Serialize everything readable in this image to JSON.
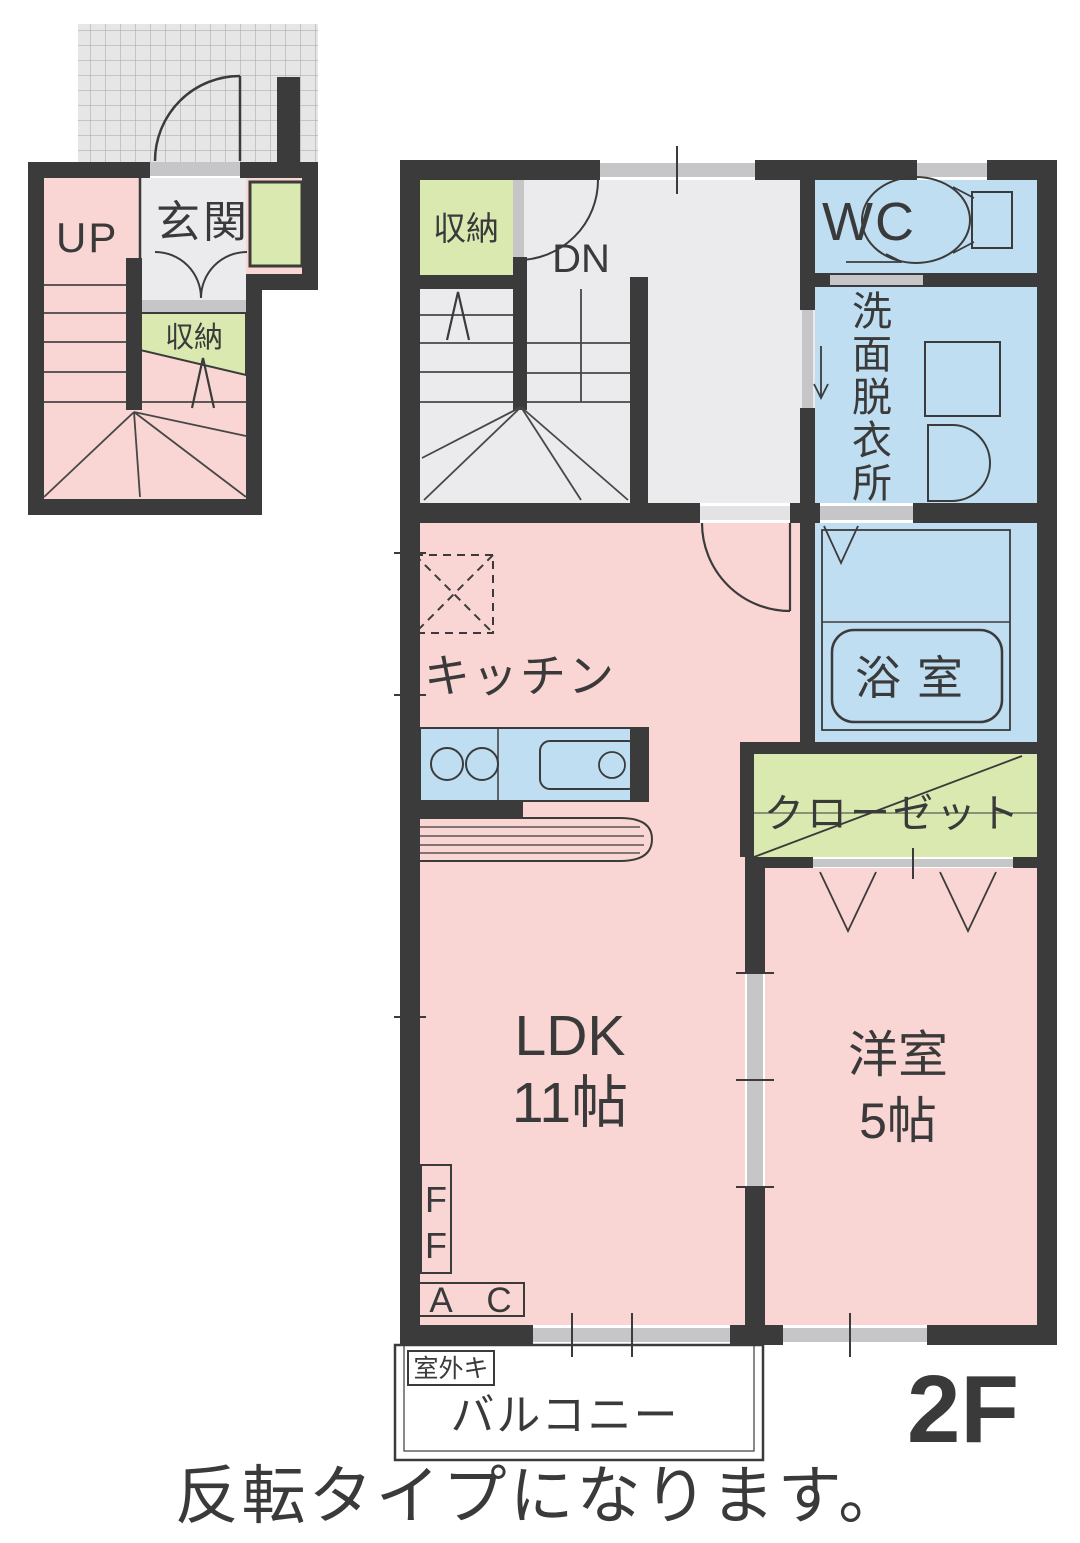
{
  "page": {
    "caption": "反転タイプになります。",
    "floor_label": "2F"
  },
  "colors": {
    "wall": "#3b3b3b",
    "room_pink": "#f9d6d3",
    "room_blue": "#bfdef1",
    "room_green": "#d9e9af",
    "hall_gray": "#ebebed",
    "opening_gray": "#c6c6c8",
    "porch_tile": "#e6e6e6"
  },
  "first_floor": {
    "up": "UP",
    "entrance": "玄関",
    "storage": "収納"
  },
  "second_floor": {
    "storage": "収納",
    "down": "DN",
    "wc": "WC",
    "washroom": "洗面脱衣所",
    "washroom_chars": [
      "洗",
      "面",
      "脱",
      "衣",
      "所"
    ],
    "bathroom": "浴室",
    "kitchen": "キッチン",
    "closet": "クローゼット",
    "ldk_name": "LDK",
    "ldk_size": "11帖",
    "western_room_name": "洋室",
    "western_room_size": "5帖",
    "ff_chars": [
      "F",
      "F"
    ],
    "ac_chars": [
      "A",
      "C"
    ],
    "outdoor_unit": "室外キ",
    "balcony": "バルコニー"
  }
}
